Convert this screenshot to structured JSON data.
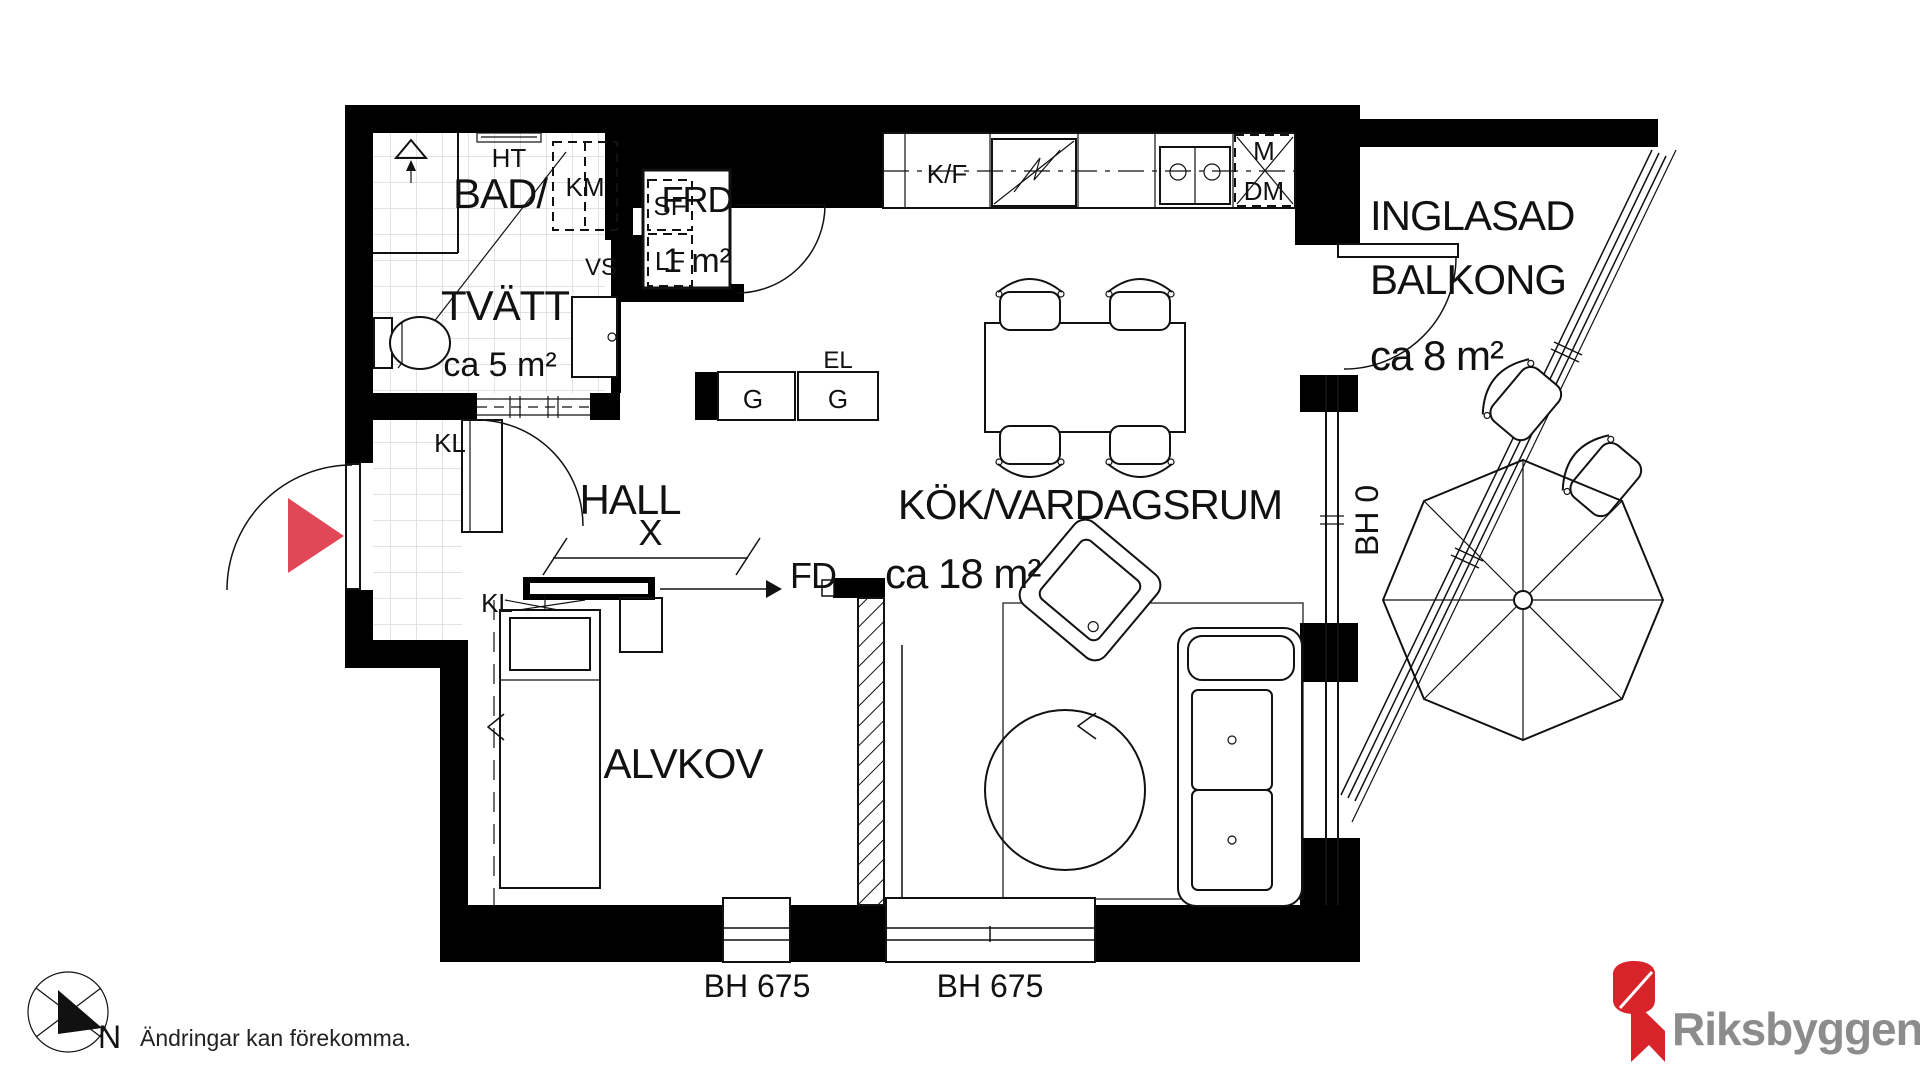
{
  "plan": {
    "rooms": {
      "bathroom": {
        "line1": "BAD/",
        "line2": "TVÄTT",
        "area": "ca 5 m²"
      },
      "storage": {
        "name": "FRD",
        "area": "1 m²"
      },
      "hall": {
        "name": "HALL"
      },
      "kitchen_living": {
        "name": "KÖK/VARDAGSRUM",
        "area": "ca 18 m²"
      },
      "alcove": {
        "name": "ALVKOV"
      },
      "balcony": {
        "line1": "INGLASAD",
        "line2": "BALKONG",
        "area": "ca 8 m²"
      }
    },
    "fixtures": {
      "towel_rail": "HT",
      "washing_machine": "KM",
      "water_heater": "VS",
      "shelf_upper": "SF",
      "shelf_lower": "LF",
      "electrical": "EL",
      "cabinet_left": "G",
      "cabinet_right": "G",
      "fridge_freezer": "K/F",
      "microwave": "M",
      "dishwasher": "DM",
      "closet_entrance": "KL",
      "closet_hall": "KL",
      "dimension_x": "X",
      "sliding_door": "FD"
    },
    "window_heights": {
      "balcony": "BH 0",
      "left": "BH 675",
      "right": "BH 675"
    },
    "compass_label": "N",
    "disclaimer": "Ändringar kan förekomma.",
    "brand": {
      "name": "Riksbyggen",
      "red": "#d8232a",
      "text_gray": "#8c8c8c"
    },
    "accent": {
      "entrance_arrow": "#e04858"
    }
  }
}
